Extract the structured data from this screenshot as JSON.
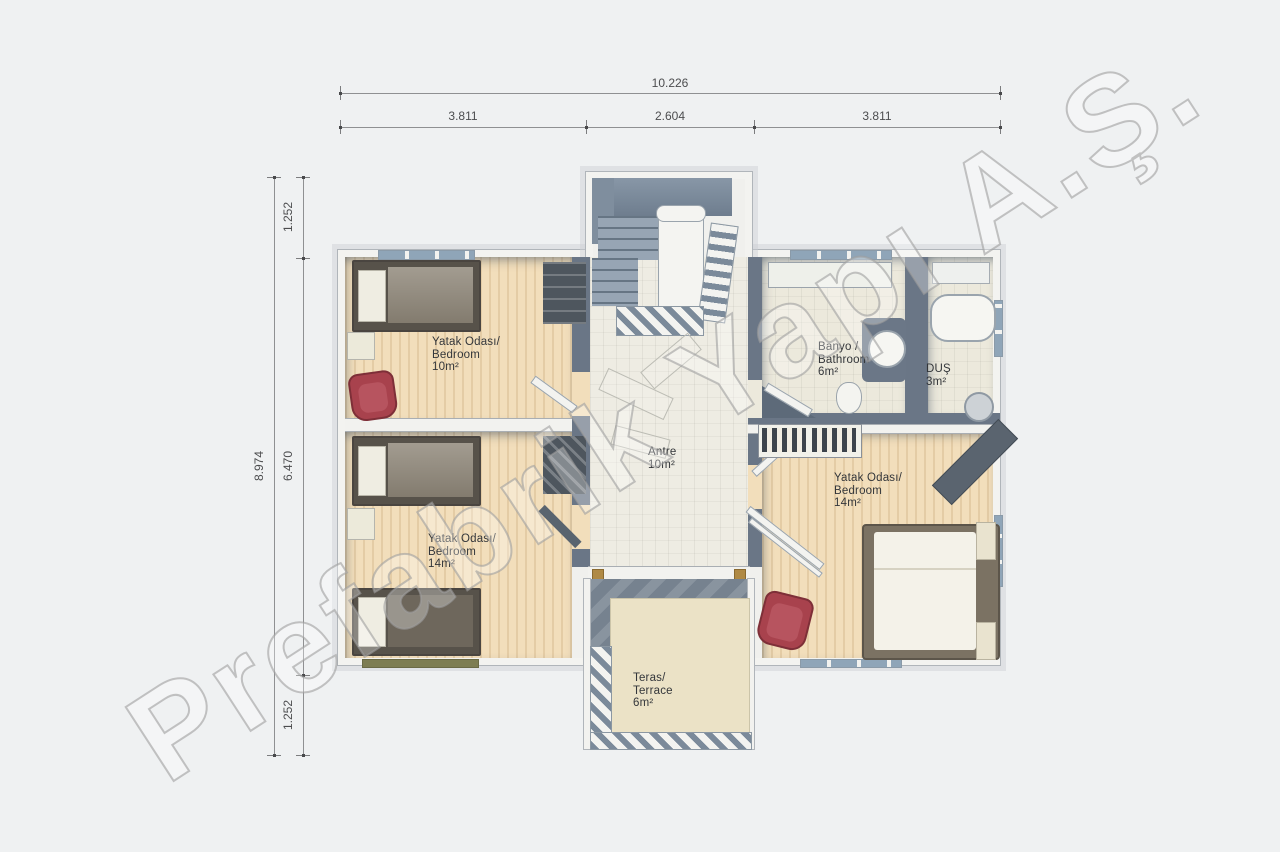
{
  "watermark": "Prefabrik Yapı A.Ş.",
  "dimensions": {
    "top": {
      "total": "10.226",
      "segments": [
        "3.811",
        "2.604",
        "3.811"
      ]
    },
    "left": {
      "total": "8.974",
      "segments": [
        "1.252",
        "6.470",
        "1.252"
      ]
    }
  },
  "rooms": [
    {
      "id": "bedroom-top-left",
      "lines": [
        "Yatak Odası/",
        "Bedroom",
        "10m²"
      ]
    },
    {
      "id": "bathroom",
      "lines": [
        "Banyo /",
        "Bathroom",
        "6m²"
      ]
    },
    {
      "id": "shower",
      "lines": [
        "DUŞ",
        "3m²"
      ]
    },
    {
      "id": "hall",
      "lines": [
        "Antre",
        "10m²"
      ]
    },
    {
      "id": "bedroom-bottom-left",
      "lines": [
        "Yatak Odası/",
        "Bedroom",
        "14m²"
      ]
    },
    {
      "id": "bedroom-right",
      "lines": [
        "Yatak Odası/",
        "Bedroom",
        "14m²"
      ]
    },
    {
      "id": "terrace",
      "lines": [
        "Teras/",
        "Terrace",
        "6m²"
      ]
    }
  ],
  "colors": {
    "background": "#eff1f2",
    "wall_slate": "#6a7686",
    "wood_floor": "#f2debb",
    "tile_floor": "#ece9dc",
    "terrace_floor": "#ebe2c6",
    "accent_red": "#a8424d",
    "watermark_stroke": "#9e9e9e"
  }
}
